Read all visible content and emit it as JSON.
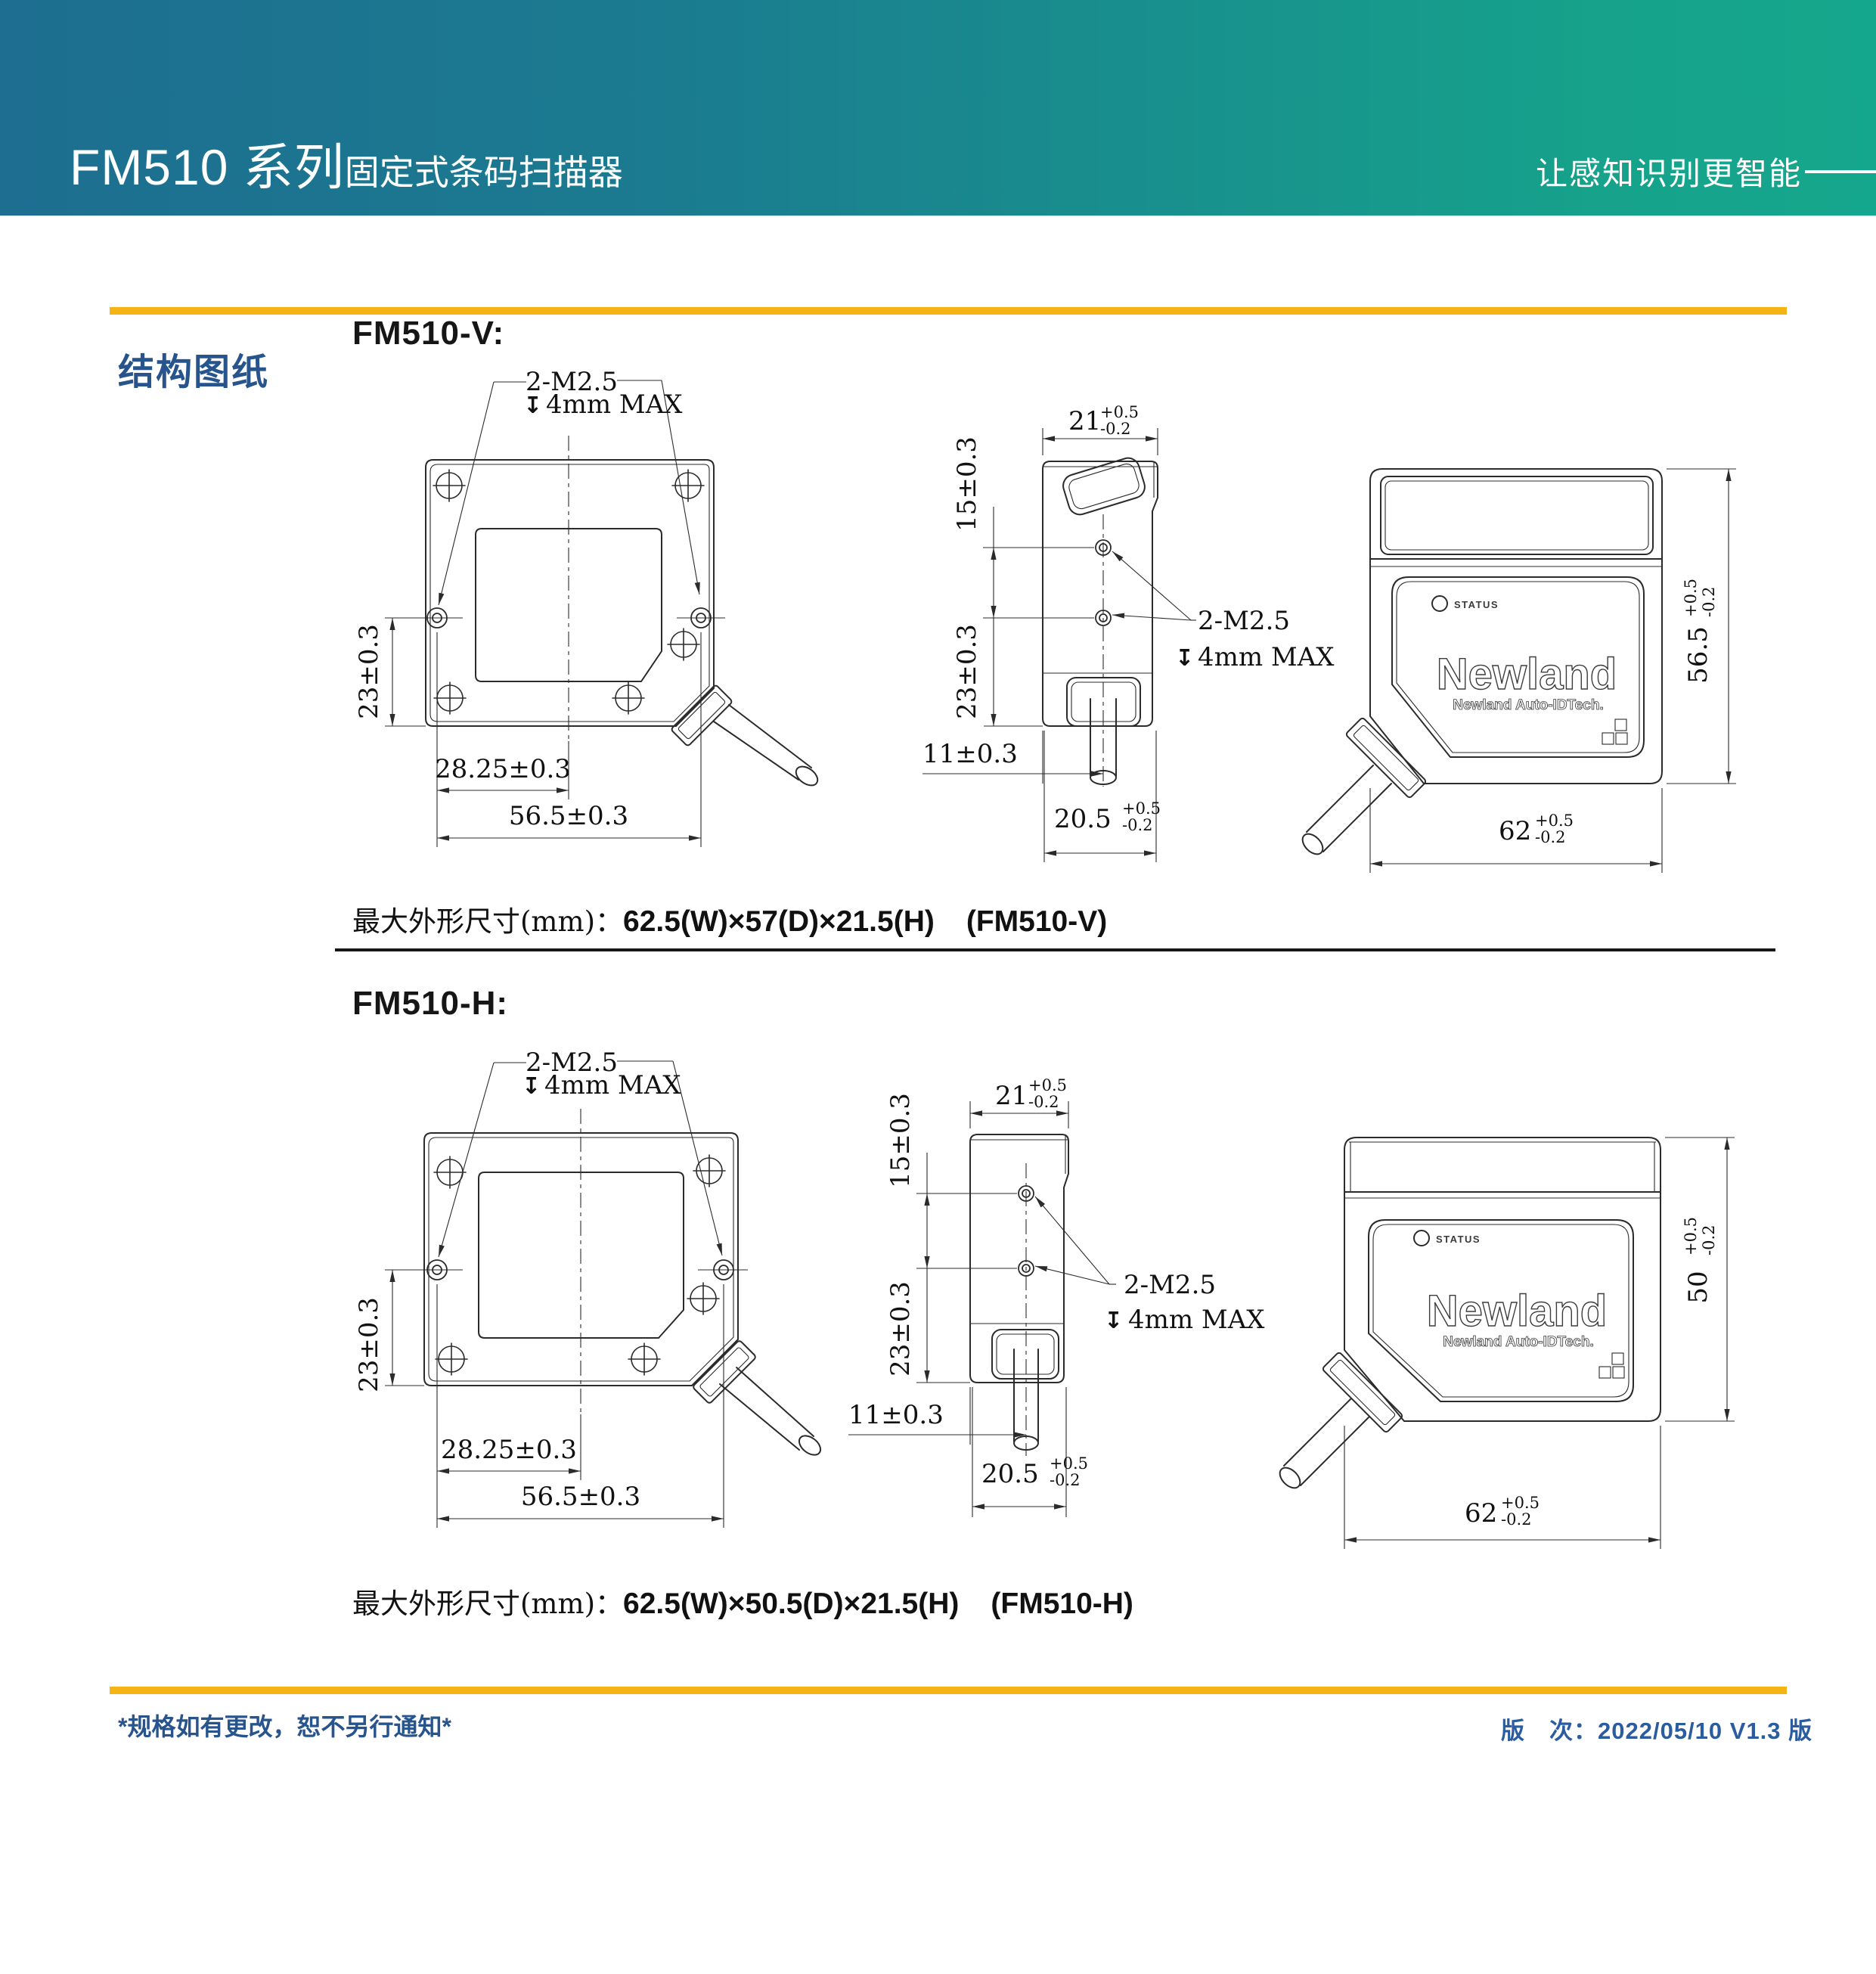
{
  "header": {
    "title": "FM510 系列",
    "subtitle": "固定式条码扫描器",
    "slogan": "让感知识别更智能"
  },
  "section": {
    "label": "结构图纸"
  },
  "variants": {
    "v": {
      "heading": "FM510-V:",
      "dims": "62.5(W)×57(D)×21.5(H)",
      "model": "(FM510-V)"
    },
    "h": {
      "heading": "FM510-H:",
      "dims": "62.5(W)×50.5(D)×21.5(H)",
      "model": "(FM510-H)"
    }
  },
  "summary": {
    "prefix": "最大外形尺寸(mm)："
  },
  "device": {
    "status": "STATUS",
    "logo": "Newland",
    "logo_sub": "Newland Auto-IDTech."
  },
  "labels": {
    "m25": "2-M2.5",
    "depth": "4mm MAX",
    "depth_sym": "↧",
    "d23": "23±0.3",
    "d2825": "28.25±0.3",
    "d565": "56.5±0.3",
    "d15": "15±0.3",
    "d11": "11±0.3",
    "d21": "21",
    "d205": "20.5",
    "d62": "62",
    "d565r": "56.5",
    "d50": "50",
    "tol_plus": "+0.5",
    "tol_minus": "-0.2"
  },
  "footer": {
    "note": "*规格如有更改，恕不另行通知*",
    "version": "版　次：2022/05/10 V1.3 版"
  },
  "colors": {
    "header_left": "#1D6E90",
    "header_right": "#16A28B",
    "accent_yellow": "#F5B415",
    "section_blue": "#27548C",
    "footer_blue": "#2B5CA0"
  }
}
